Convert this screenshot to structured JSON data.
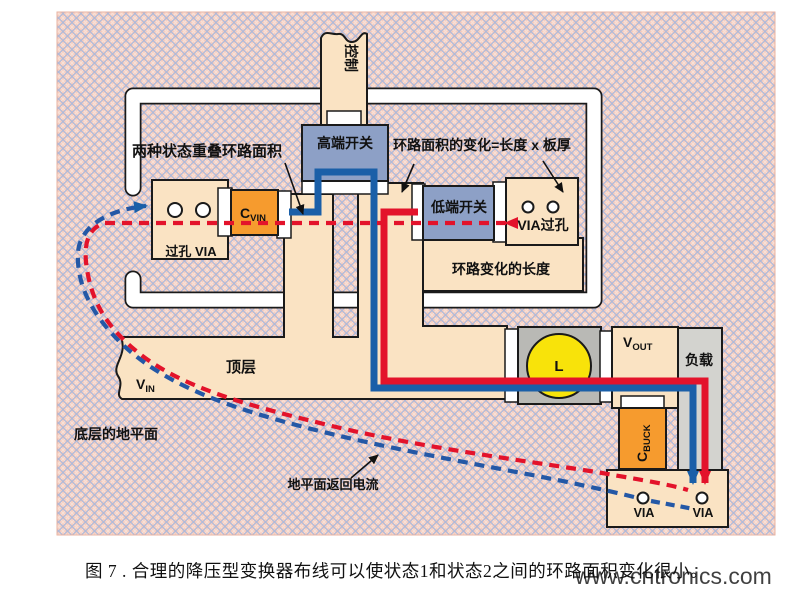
{
  "figure": {
    "caption": "图 7 . 合理的降压型变换器布线可以使状态1和状态2之间的环路面积变化很小。",
    "watermark": "www.cntronics.com"
  },
  "labels": {
    "control": "控制",
    "high_side_switch": "高端开关",
    "low_side_switch": "低端开关",
    "overlap_loop_area": "两种状态重叠环路面积",
    "loop_area_change": "环路面积的变化=长度 x 板厚",
    "loop_change_length": "环路变化的长度",
    "via_left_pad": "过孔 VIA",
    "via_right_pad": "VIA过孔",
    "top_layer": "顶层",
    "bottom_ground_plane": "底层的地平面",
    "ground_return_current": "地平面返回电流",
    "load": "负载",
    "inductor": "L",
    "via": "VIA",
    "cvin": {
      "main": "C",
      "sub": "VIN"
    },
    "cbuck": {
      "main": "C",
      "sub": "BUCK"
    },
    "vin": {
      "main": "V",
      "sub": "IN"
    },
    "vout": {
      "main": "V",
      "sub": "OUT"
    }
  },
  "colors": {
    "hatch_base": "#f5cdc0",
    "hatch_blue": "#adb9da",
    "hatch_pale": "#f9e0d6",
    "copper": "#fae3c3",
    "switch": "#8da0c6",
    "cap_orange": "#f69b2e",
    "block_gray": "#b9b9b5",
    "load_gray": "#d3d3cf",
    "inductor_yellow": "#f8e30a",
    "trace_red": "#e3132b",
    "trace_blue": "#1a5fa8",
    "dashed_blue": "#2458a6",
    "band_white": "#ffffff",
    "watermark": "#a9cd70"
  }
}
